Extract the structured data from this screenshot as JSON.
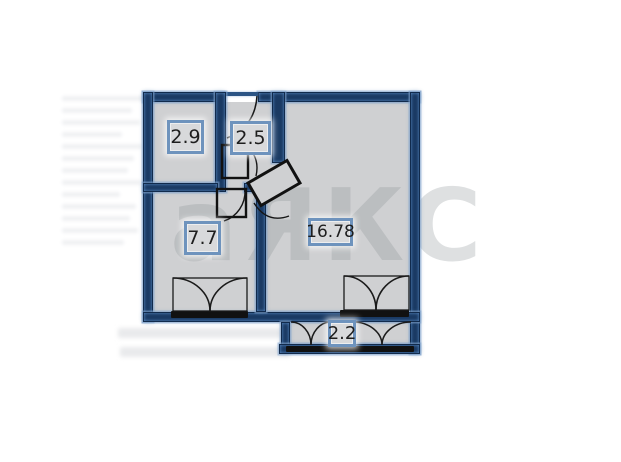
{
  "watermark": {
    "text": "аЯКС"
  },
  "floor_plan": {
    "rooms": [
      {
        "id": "room-top-left",
        "area": "2.9"
      },
      {
        "id": "hallway",
        "area": "2.5"
      },
      {
        "id": "room-left",
        "area": "7.7"
      },
      {
        "id": "room-main",
        "area": "16.78"
      },
      {
        "id": "balcony",
        "area": "2.2"
      }
    ],
    "colors": {
      "wall": "#1a3a63",
      "room_fill": "#cfd0d2",
      "label_border": "#6e93bd",
      "window": "#111111"
    }
  }
}
